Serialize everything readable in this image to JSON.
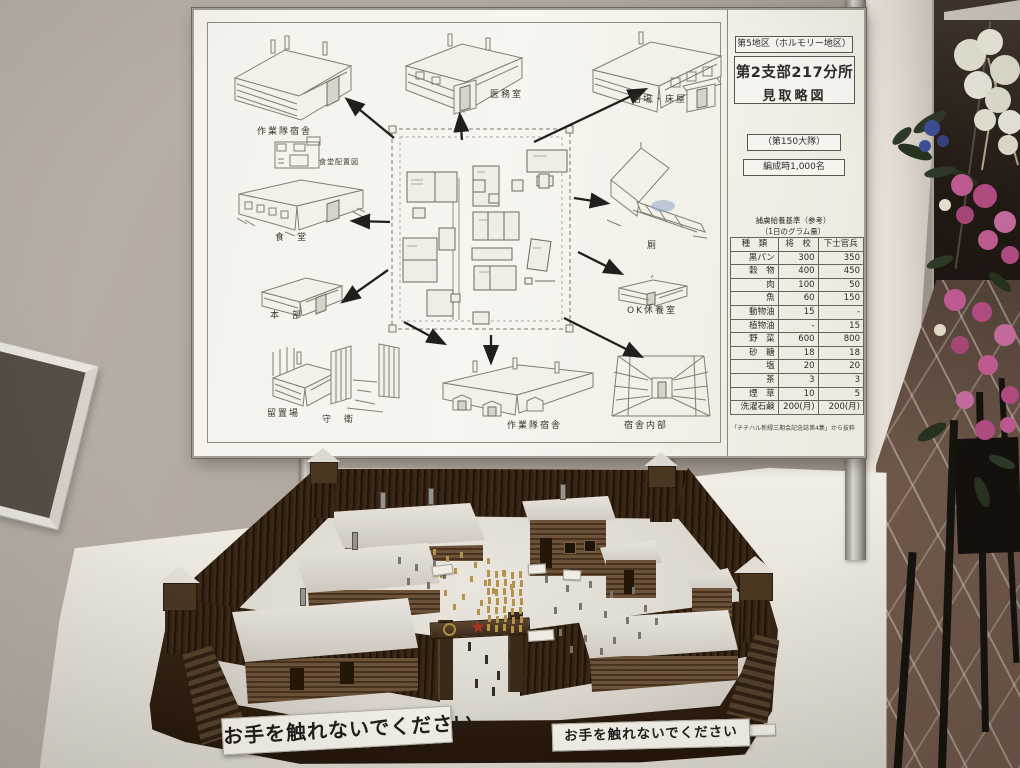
{
  "scene": {
    "description": "museum exhibit photo: site-plan board above snow diorama of internment camp",
    "signs": {
      "left": "お手を触れないでください",
      "right": "お手を触れないでください"
    }
  },
  "board": {
    "info": {
      "district": "第5地区（ホルモリー地区）",
      "title": "第2支部217分所",
      "subtitle": "見取略図",
      "battalion": "（第150大隊）",
      "strength": "編成時1,000名"
    },
    "labels": {
      "barracks_top": "作業隊宿舎",
      "infirmary": "医務室",
      "bathhouse": "浴場・床屋",
      "dining_layout": "食堂配置図",
      "dining": "食　堂",
      "toilet": "厠",
      "hq": "本　部",
      "ok_rest": "OK休養室",
      "detention": "留置場",
      "guard": "守　衛",
      "barracks_bottom": "作業隊宿舎",
      "interior": "宿舎内部"
    },
    "ration_table": {
      "title1": "捕虜給養基準（参考）",
      "title2": "（1日のグラム量）",
      "col_item": "種　類",
      "col_officer": "将　校",
      "col_enlisted": "下士官兵",
      "rows": [
        {
          "item": "黒パン",
          "officer": "300",
          "enlisted": "350"
        },
        {
          "item": "穀　物",
          "officer": "400",
          "enlisted": "450"
        },
        {
          "item": "肉",
          "officer": "100",
          "enlisted": "50"
        },
        {
          "item": "魚",
          "officer": "60",
          "enlisted": "150"
        },
        {
          "item": "動物油",
          "officer": "15",
          "enlisted": "-"
        },
        {
          "item": "植物油",
          "officer": "-",
          "enlisted": "15"
        },
        {
          "item": "野　菜",
          "officer": "600",
          "enlisted": "800"
        },
        {
          "item": "砂　糖",
          "officer": "18",
          "enlisted": "18"
        },
        {
          "item": "塩",
          "officer": "20",
          "enlisted": "20"
        },
        {
          "item": "茶",
          "officer": "3",
          "enlisted": "3"
        },
        {
          "item": "煙　草",
          "officer": "10",
          "enlisted": "5"
        },
        {
          "item": "洗濯石鹸",
          "officer": "200(月)",
          "enlisted": "200(月)"
        }
      ],
      "footnote": "「チチハル新緑三期会記念誌第4集」から抜粋"
    }
  },
  "colors": {
    "wall": "#aba297",
    "board_paper": "#f5f3ee",
    "ink": "#39352e",
    "palisade_wood": "#2f2012",
    "cabin_wood": "#5d4531",
    "snow": "#e3dfd8",
    "prisoner_gold": "#b3944a",
    "guard_gray": "#7a746a",
    "gate_star_red": "#b03226",
    "rose_pink": "#c25c93",
    "floor_tile": "#6e584a"
  }
}
